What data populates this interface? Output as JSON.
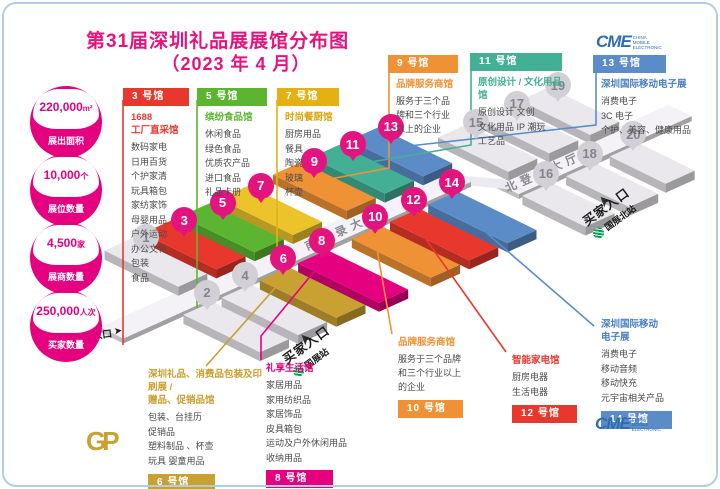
{
  "page": {
    "title_line1": "第31届深圳礼品展展馆分布图",
    "title_line2": "（2023 年 4 月）"
  },
  "stats": [
    {
      "value": "220,000",
      "unit": "m²",
      "label": "展出面积"
    },
    {
      "value": "10,000",
      "unit": "个",
      "label": "展位数量"
    },
    {
      "value": "4,500",
      "unit": "家",
      "label": "展商数量"
    },
    {
      "value": "250,000",
      "unit": "人次",
      "label": "买家数量"
    }
  ],
  "halls": {
    "h3": {
      "tag": "3 号馆",
      "title": [
        "1688",
        "工厂直采馆"
      ],
      "items": [
        "数码家电",
        "日用百货",
        "个护家清",
        "玩具箱包",
        "家纺家饰",
        "母婴用品",
        "户外运动",
        "办公文化",
        "包装",
        "食品"
      ]
    },
    "h5": {
      "tag": "5 号馆",
      "title": [
        "缤纷食品馆"
      ],
      "items": [
        "休闲食品",
        "绿色食品",
        "优质农产品",
        "进口食品",
        "礼品卡册"
      ]
    },
    "h7": {
      "tag": "7 号馆",
      "title": [
        "时尚餐厨馆"
      ],
      "items": [
        "厨房用品",
        "餐具",
        "陶瓷",
        "玻璃",
        "杯壶"
      ]
    },
    "h9": {
      "tag": "9 号馆",
      "title": [
        "品牌服务商馆"
      ],
      "body": "服务于三个品牌和三个行业以上的企业"
    },
    "h11": {
      "tag": "11 号馆",
      "title": [
        "原创设计 / 文化用品馆"
      ],
      "items": [
        "原创设计  文创",
        "文化用品  IP 潮玩",
        "工艺品"
      ]
    },
    "h13": {
      "tag": "13 号馆",
      "title": [
        "深圳国际移动电子展"
      ],
      "items": [
        "消费电子",
        "3C 电子",
        "个护、美容、健康用品"
      ]
    },
    "h6": {
      "tag": "6 号馆",
      "title": [
        "深圳礼品、消费品包装及印刷展 /",
        "赠品、促销品馆"
      ],
      "items": [
        "包装、台挂历",
        "促销品",
        "塑料制品 、杯壶",
        "玩具  婴童用品"
      ]
    },
    "h8": {
      "tag": "8 号馆",
      "title": [
        "礼享生活馆"
      ],
      "items": [
        "家居用品",
        "家用纺织品",
        "家居饰品",
        "皮具箱包",
        "运动及户外休闲用品",
        "收纳用品"
      ]
    },
    "h10": {
      "tag": "10 号馆",
      "title": [
        "品牌服务商馆"
      ],
      "body": "服务于三个品牌和三个行业以上的企业"
    },
    "h12": {
      "tag": "12 号馆",
      "title": [
        "智能家电馆"
      ],
      "items": [
        "厨房电器",
        "生活电器"
      ]
    },
    "h14": {
      "tag": "14 号馆",
      "title": [
        "深圳国际移动",
        "电子展"
      ],
      "items": [
        "消费电子",
        "移动音频",
        "移动快充",
        "元宇宙相关产品"
      ]
    }
  },
  "map": {
    "south_hall_label": "南登录大厅",
    "north_hall_label": "北登录大厅",
    "south_entrance": "南入口",
    "buyer_entrance_south": "买家入口",
    "buyer_entrance_north": "买家入口",
    "station_south": "国展站",
    "station_north": "国展北站",
    "pins": [
      {
        "number": "1",
        "gray": true,
        "hall_color": "#eae8ed"
      },
      {
        "number": "2",
        "gray": true,
        "hall_color": "#eae8ed"
      },
      {
        "number": "3",
        "gray": false,
        "hall_color": "#e8382d"
      },
      {
        "number": "4",
        "gray": true,
        "hall_color": "#eae8ed"
      },
      {
        "number": "5",
        "gray": false,
        "hall_color": "#5cb531"
      },
      {
        "number": "6",
        "gray": false,
        "hall_color": "#c9a032"
      },
      {
        "number": "7",
        "gray": false,
        "hall_color": "#edc32b"
      },
      {
        "number": "8",
        "gray": false,
        "hall_color": "#e5007f"
      },
      {
        "number": "9",
        "gray": false,
        "hall_color": "#ef9236"
      },
      {
        "number": "10",
        "gray": false,
        "hall_color": "#ef9236"
      },
      {
        "number": "11",
        "gray": false,
        "hall_color": "#43b095"
      },
      {
        "number": "12",
        "gray": false,
        "hall_color": "#e8382d"
      },
      {
        "number": "13",
        "gray": false,
        "hall_color": "#5b8cc8"
      },
      {
        "number": "14",
        "gray": false,
        "hall_color": "#5b8cc8"
      },
      {
        "number": "15",
        "gray": true,
        "hall_color": "#eae8ed"
      },
      {
        "number": "16",
        "gray": true,
        "hall_color": "#eae8ed"
      },
      {
        "number": "17",
        "gray": true,
        "hall_color": "#eae8ed"
      },
      {
        "number": "18",
        "gray": true,
        "hall_color": "#eae8ed"
      },
      {
        "number": "19",
        "gray": true,
        "hall_color": "#eae8ed"
      },
      {
        "number": "20",
        "gray": true,
        "hall_color": "#eae8ed"
      }
    ]
  },
  "logos": {
    "cme": "CME",
    "cme_lines": [
      "CHINA",
      "MOBILE",
      "ELECTRONIC"
    ],
    "gp": "GP"
  },
  "colors": {
    "brand_pink": "#e4007f",
    "metro_green": "#00a650",
    "cme_blue": "#2e6db4",
    "frame_blue": "#aecfe3",
    "pin_magenta": "#e4147f",
    "pin_gray": "#d2d0d6",
    "walkway": "#f4f2f6"
  }
}
